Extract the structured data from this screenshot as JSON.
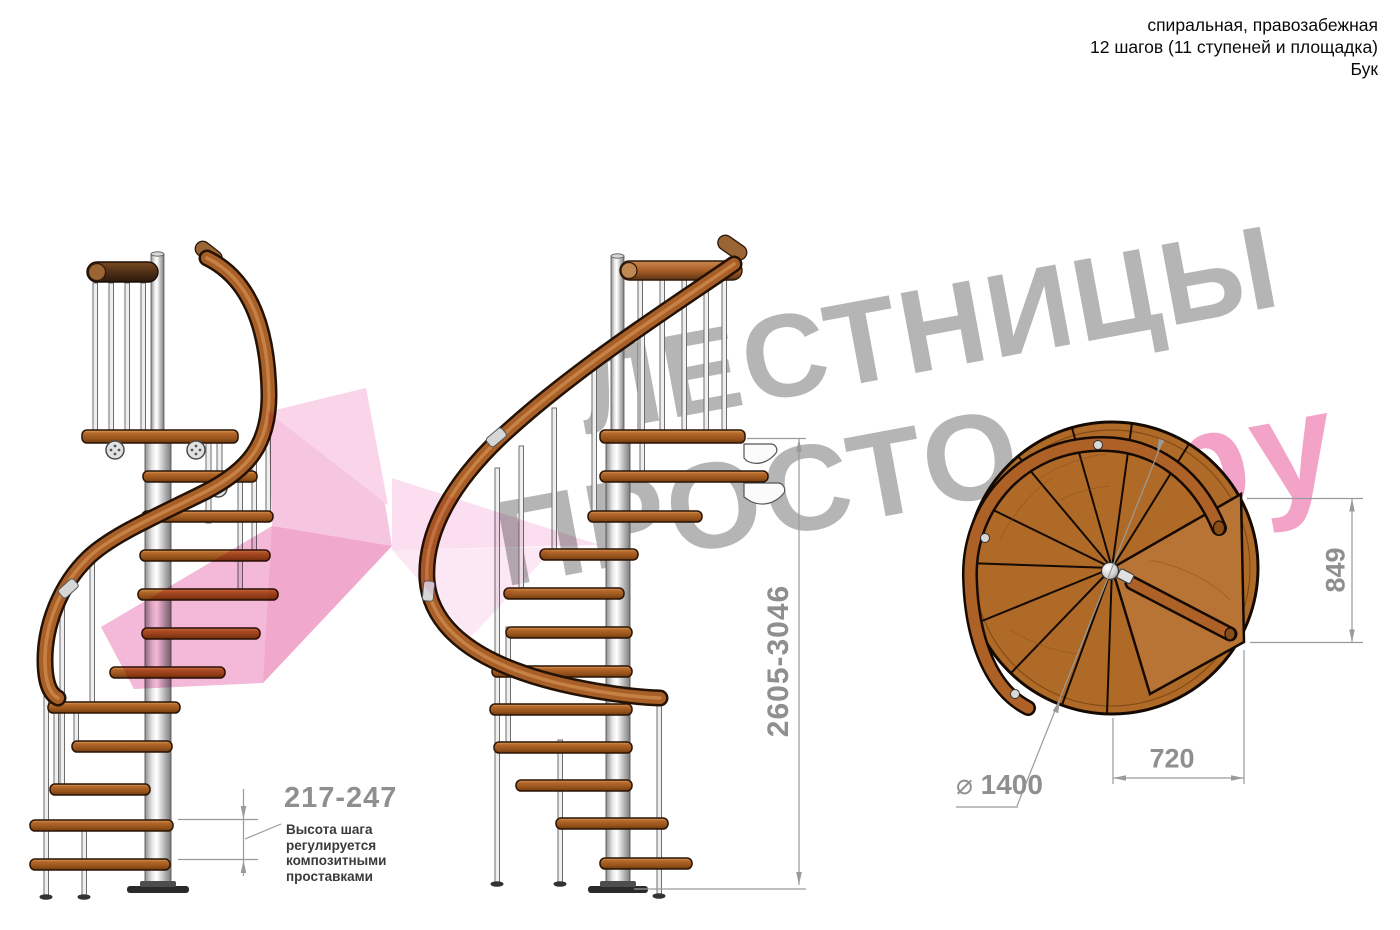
{
  "header": {
    "line1": "спиральная, правозабежная",
    "line2": "12 шагов (11 ступеней и площадка)",
    "line3": "Бук"
  },
  "watermark": {
    "brand_word1": "ЛЕСТНИЦЫ",
    "brand_word2": "ПРОСТО",
    "brand_suffix": "ру"
  },
  "dimensions": {
    "step_height": {
      "value": "217-247",
      "note_lines": [
        "Высота шага",
        "регулируется",
        "композитными",
        "проставками"
      ]
    },
    "total_height": {
      "value": "2605-3046"
    },
    "plan_depth": {
      "value": "849"
    },
    "plan_width": {
      "value": "720"
    },
    "diameter": {
      "symbol": "⌀",
      "value": "1400"
    }
  },
  "colors": {
    "wood": "#b5692a",
    "wood_dark": "#7c3f10",
    "handrail": "#a95f28",
    "metal": "#e8e8e8",
    "watermark_gray": "#b5b5b5",
    "watermark_pink": "#f2a3c7",
    "watermark_dot": "#e84a7c",
    "dimension_gray": "#8f8f8f"
  }
}
